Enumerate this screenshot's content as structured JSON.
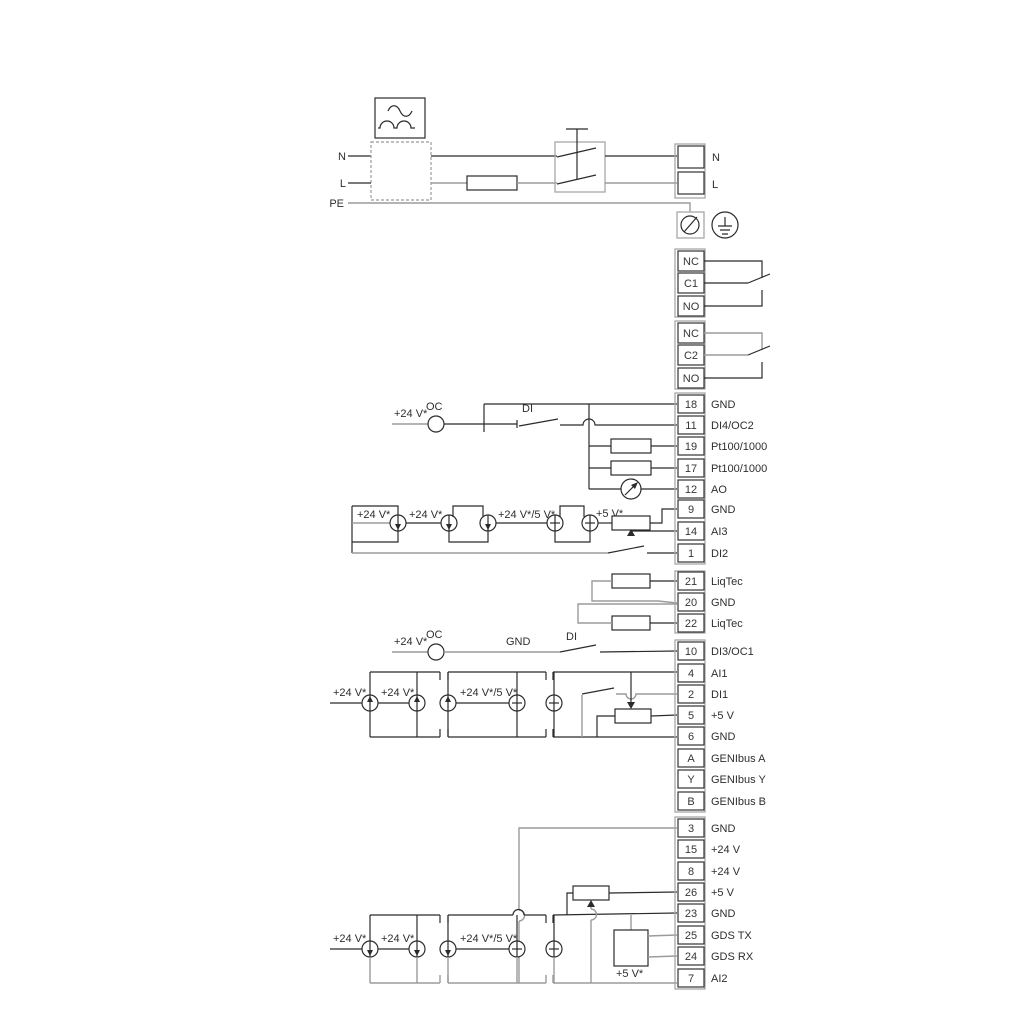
{
  "power": {
    "n_left": "N",
    "l_left": "L",
    "pe_left": "PE",
    "n_right": "N",
    "l_right": "L"
  },
  "relays": [
    {
      "cells": [
        "NC",
        "C1",
        "NO"
      ]
    },
    {
      "cells": [
        "NC",
        "C2",
        "NO"
      ]
    }
  ],
  "terminals": [
    {
      "num": "18",
      "label": "GND"
    },
    {
      "num": "11",
      "label": "DI4/OC2"
    },
    {
      "num": "19",
      "label": "Pt100/1000"
    },
    {
      "num": "17",
      "label": "Pt100/1000"
    },
    {
      "num": "12",
      "label": "AO"
    },
    {
      "num": "9",
      "label": "GND"
    },
    {
      "num": "14",
      "label": "AI3"
    },
    {
      "num": "1",
      "label": "DI2"
    },
    {
      "num": "21",
      "label": "LiqTec"
    },
    {
      "num": "20",
      "label": "GND"
    },
    {
      "num": "22",
      "label": "LiqTec"
    },
    {
      "num": "10",
      "label": "DI3/OC1"
    },
    {
      "num": "4",
      "label": "AI1"
    },
    {
      "num": "2",
      "label": "DI1"
    },
    {
      "num": "5",
      "label": "+5 V"
    },
    {
      "num": "6",
      "label": "GND"
    },
    {
      "num": "A",
      "label": "GENIbus A"
    },
    {
      "num": "Y",
      "label": "GENIbus Y"
    },
    {
      "num": "B",
      "label": "GENIbus B"
    },
    {
      "num": "3",
      "label": "GND"
    },
    {
      "num": "15",
      "label": "+24 V"
    },
    {
      "num": "8",
      "label": "+24 V"
    },
    {
      "num": "26",
      "label": "+5 V"
    },
    {
      "num": "23",
      "label": "GND"
    },
    {
      "num": "25",
      "label": "GDS TX"
    },
    {
      "num": "24",
      "label": "GDS RX"
    },
    {
      "num": "7",
      "label": "AI2"
    }
  ],
  "labels": {
    "v24": "+24 V*",
    "v24v5": "+24 V*/5 V*",
    "v5": "+5 V*",
    "oc": "OC",
    "di": "DI",
    "gnd": "GND"
  },
  "colors": {
    "line_black": "#2b2b2b",
    "line_gray": "#9b9b9b",
    "strip_gray": "#a8a8a8"
  }
}
